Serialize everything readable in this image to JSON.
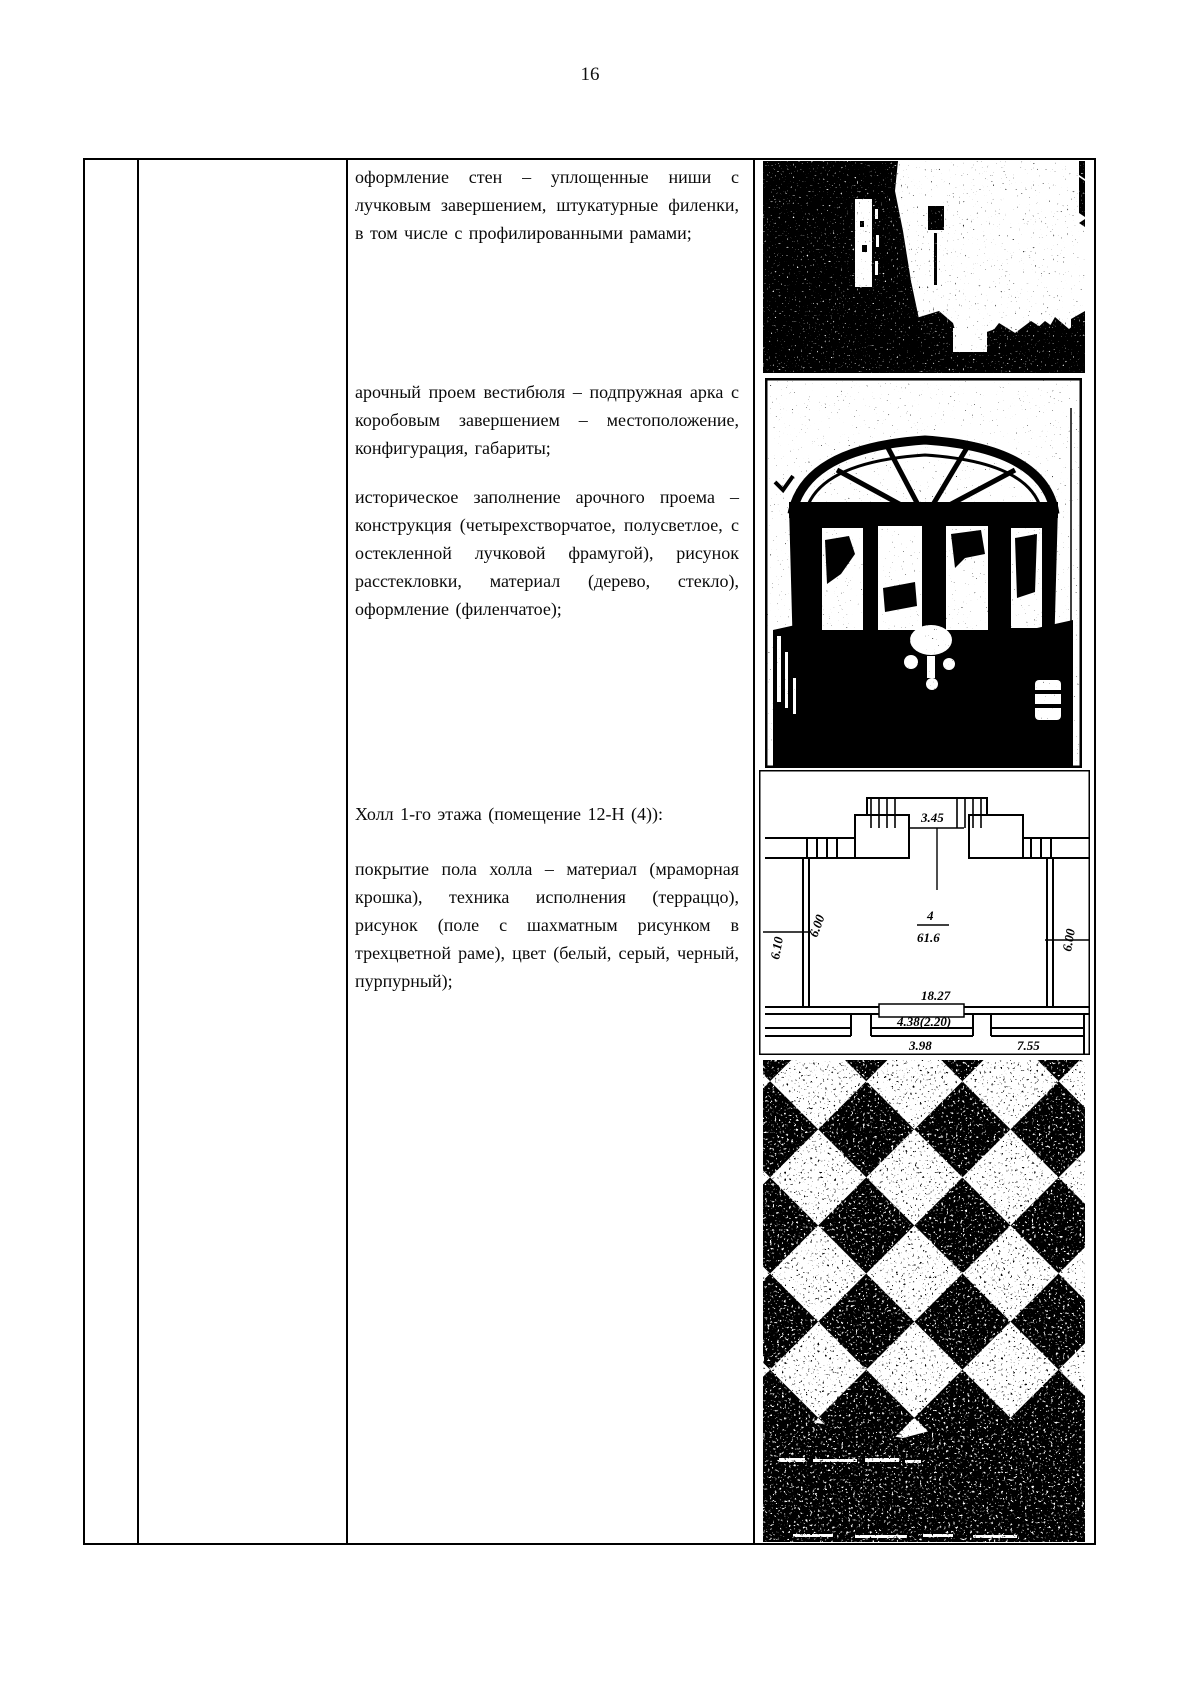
{
  "page": {
    "number": "16"
  },
  "content": {
    "paragraphs": [
      "оформление стен – уплощенные ниши с лучковым завершением, штукатурные филенки, в том числе с профилированными рамами;",
      "арочный проем вестибюля – подпружная арка с коробовым завершением – местоположение, конфигурация, габариты;",
      "историческое заполнение арочного проема – конструкция (четырехстворчатое, полусветлое, с остекленной лучковой фрамугой), рисунок расстекловки, материал (дерево, стекло), оформление (филенчатое);",
      "Холл 1-го этажа (помещение 12-Н (4)):",
      "покрытие пола холла – материал (мраморная крошка), техника исполнения (терраццо), рисунок (поле с шахматным рисунком в трехцветной раме), цвет (белый, серый, черный, пурпурный);"
    ]
  },
  "plan": {
    "labels": {
      "top_width": "3.45",
      "room_number": "4",
      "room_area": "61.6",
      "left_dim": "6.10",
      "left_dim2": "6.00",
      "right_dim": "6.00",
      "bottom_width": "18.27",
      "door_width": "4.38(2.20)",
      "bottom_left": "3.98",
      "bottom_right": "7.55"
    }
  },
  "colors": {
    "ink": "#000000",
    "paper": "#ffffff"
  }
}
